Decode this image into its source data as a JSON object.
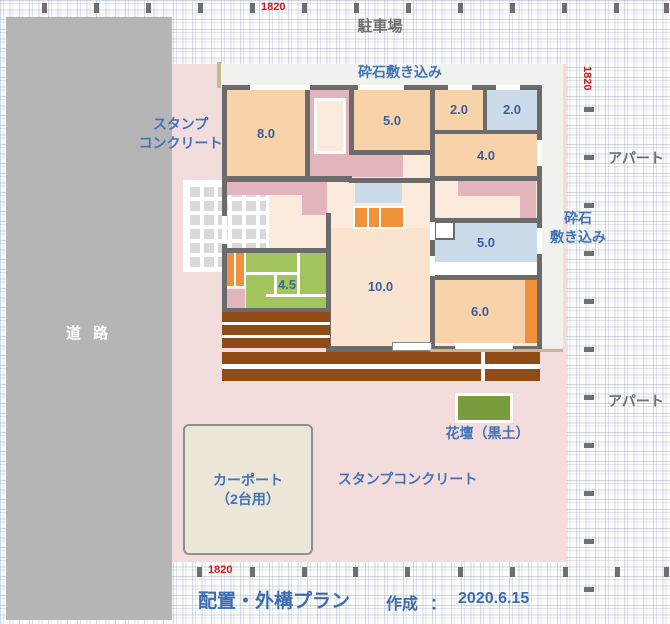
{
  "colors": {
    "road": "#b5b5b5",
    "plan": "#f3dcdc",
    "gravel": "#f1f1ee",
    "house": "#fcebdc",
    "room_peach": "#f8d2a8",
    "room_peach_light": "#fae3cf",
    "room_blue": "#ccdbe9",
    "tatami_green": "#a2c55e",
    "closet_pink": "#e2b5bd",
    "orange": "#ef923b",
    "flowerbed": "#7b9c3c",
    "wall": "#6b6b6b",
    "carport": "#ece7d8",
    "fence_tan": "#c9b695",
    "white": "#ffffff"
  },
  "texts": {
    "road": "道 路",
    "parking": "駐車場",
    "gravel_top": "砕石敷き込み",
    "gravel_right_line1": "砕石",
    "gravel_right_line2": "敷き込み",
    "apartment_top": "アパート",
    "apartment_bottom": "アパート",
    "stamp_left_line1": "スタンプ",
    "stamp_left_line2": "コンクリート",
    "stamp_bottom": "スタンプコンクリート",
    "carport_line1": "カーポート",
    "carport_line2": "（2台用）",
    "flowerbed": "花壇（黒土）"
  },
  "rooms": {
    "r8": {
      "label": "8.0"
    },
    "r5a": {
      "label": "5.0"
    },
    "r2a": {
      "label": "2.0"
    },
    "r2b": {
      "label": "2.0"
    },
    "r4": {
      "label": "4.0"
    },
    "r5b": {
      "label": "5.0"
    },
    "r10": {
      "label": "10.0"
    },
    "r45": {
      "label": "4.5"
    },
    "r6": {
      "label": "6.0"
    }
  },
  "dimensions": {
    "top": "1820",
    "right": "1820",
    "bottom": "1820"
  },
  "footer": {
    "title": "配置・外構プラン",
    "created_label": "作成",
    "separator": "：",
    "date": "2020.6.15"
  }
}
